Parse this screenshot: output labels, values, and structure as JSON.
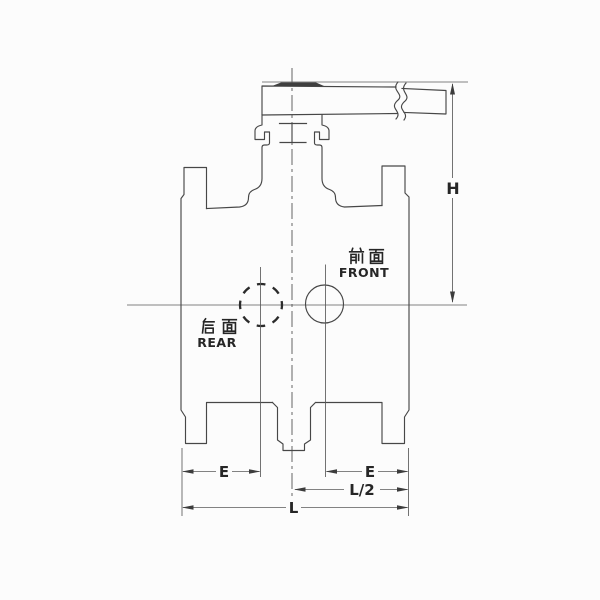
{
  "figure": {
    "background_color": "#fcfcfc",
    "line_color": "#474747",
    "labels": {
      "front_cn": "前面",
      "front_en": "FRONT",
      "rear_cn": "后面",
      "rear_en": "REAR"
    },
    "dimensions": {
      "height_label": "H",
      "e_left_label": "E",
      "e_right_label": "E",
      "half_length_label": "L/2",
      "length_label": "L"
    }
  }
}
